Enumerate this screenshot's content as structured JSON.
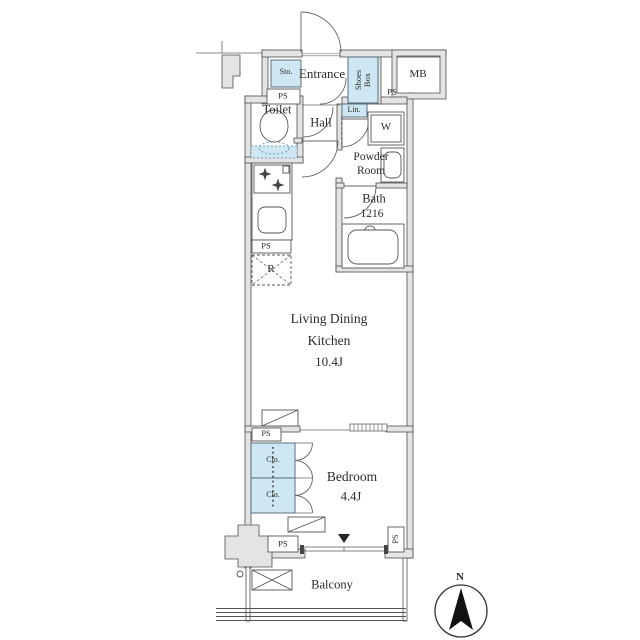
{
  "floorplan": {
    "rooms": {
      "entrance": "Entrance",
      "toilet": "Toilet",
      "hall": "Hall",
      "powder_room_line1": "Powder",
      "powder_room_line2": "Room",
      "bath": "Bath",
      "bath_size": "1216",
      "ldk_line1": "Living Dining",
      "ldk_line2": "Kitchen",
      "ldk_size": "10.4J",
      "bedroom": "Bedroom",
      "bedroom_size": "4.4J",
      "balcony": "Balcony"
    },
    "storage": {
      "sto": "Sto.",
      "shoes_box": "Shoes Box",
      "lin": "Lin.",
      "clo": "Clo."
    },
    "labels": {
      "ps": "PS",
      "mb": "MB",
      "w": "W",
      "r": "R",
      "north": "N"
    },
    "colors": {
      "wall_fill": "#e4e4e4",
      "line": "#4d4d4d",
      "closet_blue": "#cfe7f3",
      "closet_border": "#4e6370",
      "dark": "#222222"
    }
  }
}
